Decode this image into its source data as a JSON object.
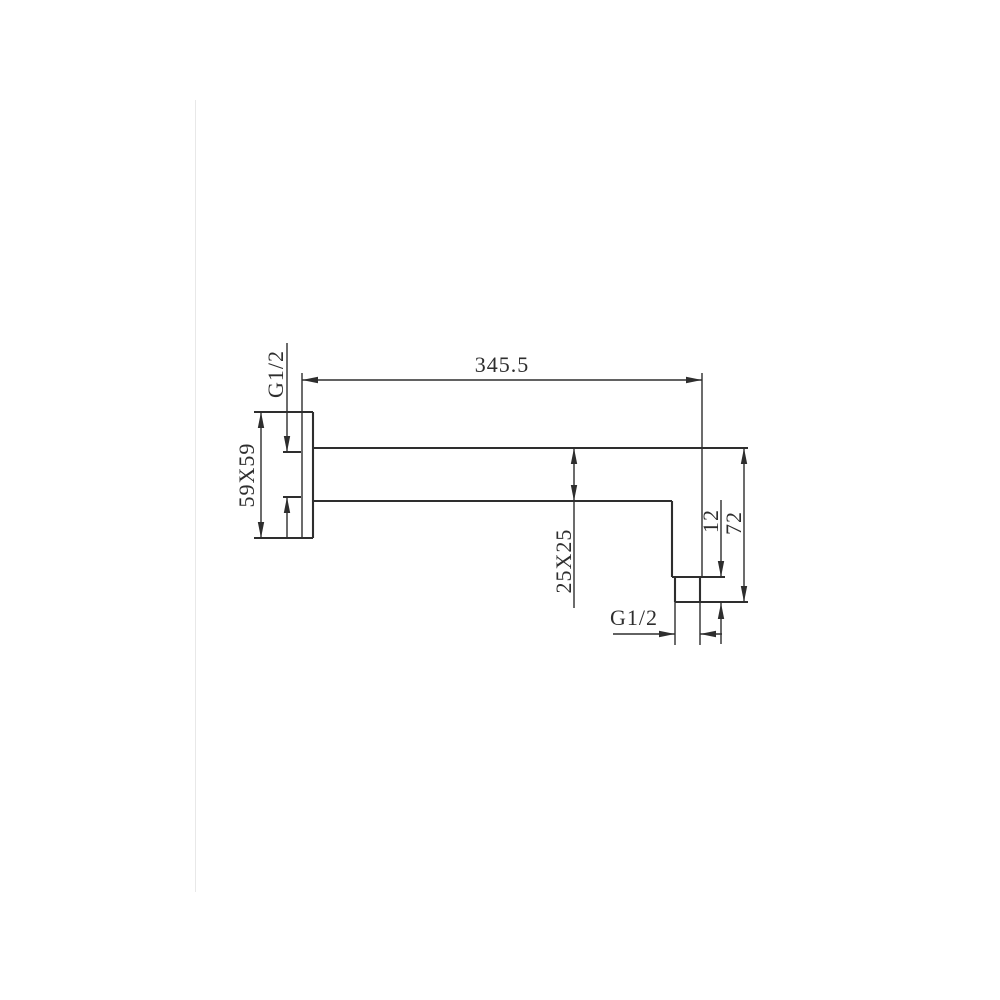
{
  "colors": {
    "ink": "#2e2e2e",
    "bg": "#ffffff",
    "edge": "#e8e8e8"
  },
  "drawing": {
    "dimensions": {
      "total_length": "345.5",
      "inlet_thread": "G1/2",
      "flange_size": "59X59",
      "arm_cross_section": "25X25",
      "outlet_nipple_height": "12",
      "drop_height": "72",
      "outlet_thread": "G1/2"
    }
  }
}
